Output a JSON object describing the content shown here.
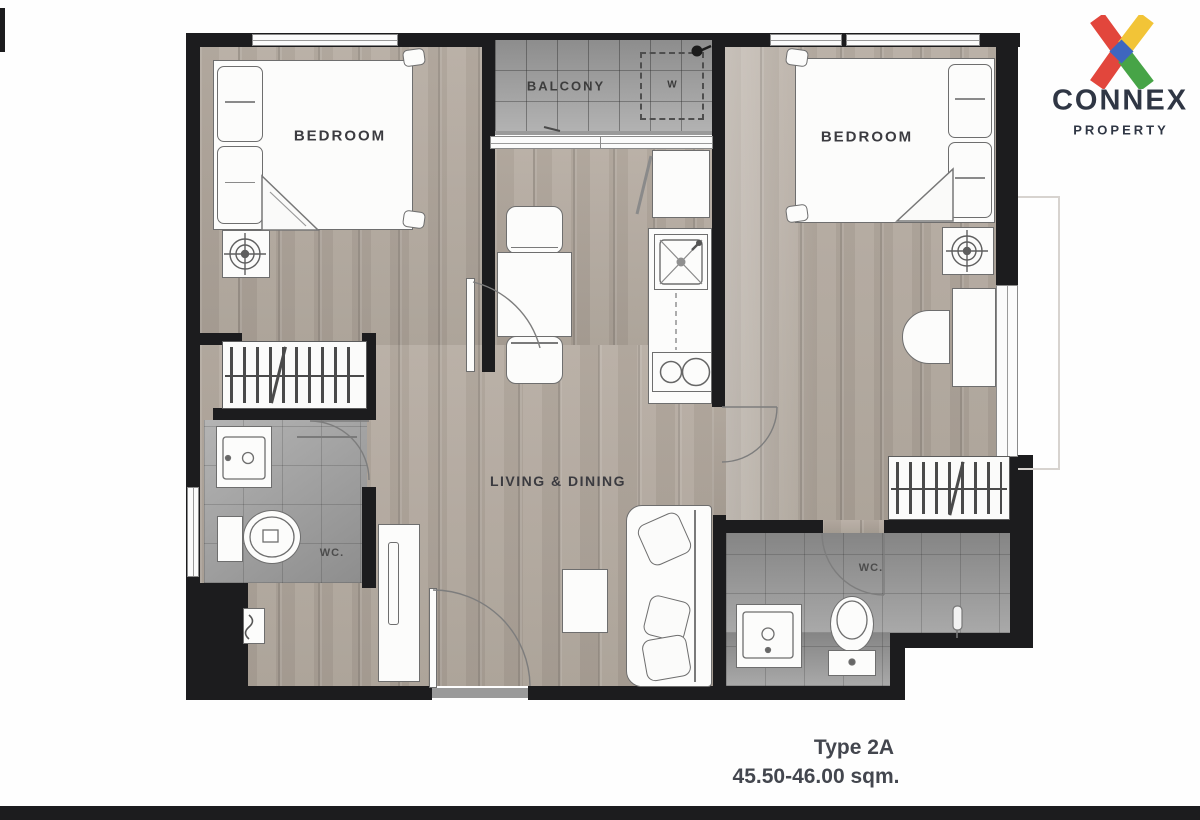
{
  "watermark_logo": {
    "brand": "CONNEX",
    "tagline": "PROPERTY",
    "colors": {
      "red": "#e2463c",
      "yellow": "#f2c437",
      "green": "#47a447",
      "blue": "#3e66bf",
      "text": "#2f3644"
    }
  },
  "unit_info": {
    "type_label": "Type 2A",
    "area_label": "45.50-46.00 sqm."
  },
  "rooms": {
    "bedroom_left": {
      "label": "BEDROOM"
    },
    "bedroom_right": {
      "label": "BEDROOM"
    },
    "balcony": {
      "label": "BALCONY"
    },
    "living_dining": {
      "label": "LIVING & DINING"
    },
    "wc_left": {
      "label": "WC."
    },
    "wc_right": {
      "label": "WC."
    },
    "washer_zone": {
      "label": "W"
    }
  }
}
